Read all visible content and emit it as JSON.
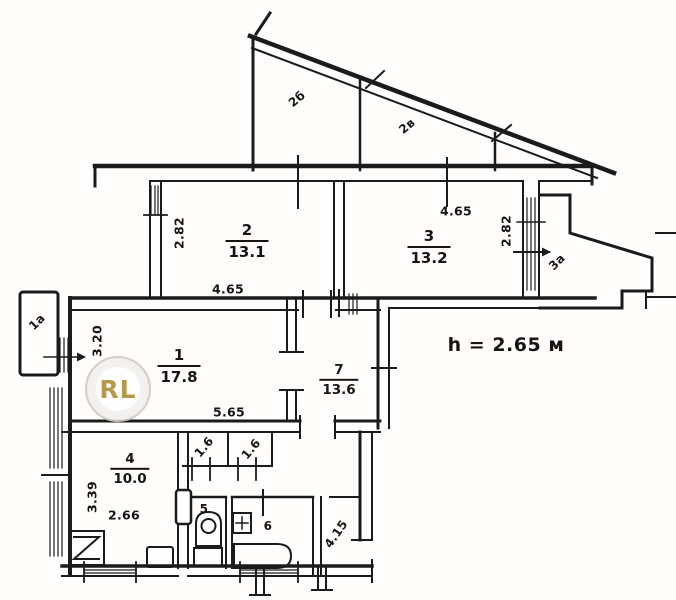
{
  "floorplan": {
    "title": "apartment-floor-plan",
    "height_note": "h = 2.65 м",
    "watermark": "RL",
    "ink_color": "#1b1b1b",
    "watermark_gold": "#b3913d",
    "rooms": {
      "r1": {
        "number": "1",
        "area": "17.8"
      },
      "r2": {
        "number": "2",
        "area": "13.1"
      },
      "r3": {
        "number": "3",
        "area": "13.2"
      },
      "r4": {
        "number": "4",
        "area": "10.0"
      },
      "r5": {
        "number": "5"
      },
      "r6": {
        "number": "6"
      },
      "r7": {
        "number": "7",
        "area": "13.6"
      }
    },
    "dims": {
      "r1_width": "5.65",
      "r1_height": "3.20",
      "r2_width": "4.65",
      "r2_height": "2.82",
      "r3_width": "4.65",
      "r3_height": "2.82",
      "r4_width": "2.66",
      "r4_height": "3.39"
    },
    "annexes": {
      "left_balcony": "1а",
      "top_balcony_left": "2б",
      "top_balcony_right": "2в",
      "right_balcony": "3а",
      "closet_a": "1.6",
      "closet_b": "1.6",
      "hallway": "4.15"
    }
  }
}
